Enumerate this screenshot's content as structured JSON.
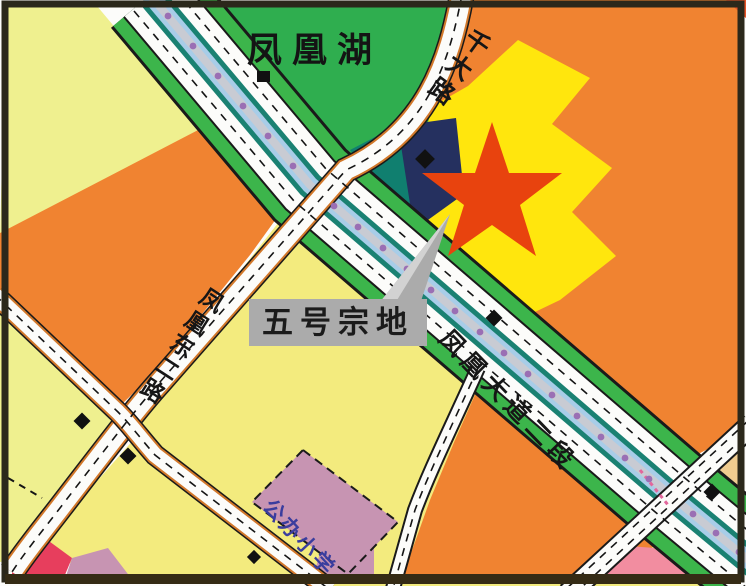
{
  "map": {
    "labels": {
      "lake": "凤凰湖",
      "plot_callout": "五号宗地",
      "school": "公办小学",
      "road_main": "凤凰大道二段",
      "road_north": "千大路",
      "road_west": "凤凰东二路"
    },
    "colors": {
      "park_green": "#2FAE4F",
      "verge_green": "#3CB54B",
      "median_teal": "#1A8172",
      "median_blue": "#A8CDE8",
      "median_gray": "#C8CBD3",
      "tree_purple": "#9A6FB4",
      "road_white": "#FCFCFA",
      "road_edge": "#1A1A1A",
      "minor_edge_orange": "#D2782A",
      "parcel_pale_yellow": "#EFF08F",
      "parcel_yellow": "#F3EB7E",
      "parcel_orange": "#F08331",
      "plot_yellow": "#FFE60D",
      "parcel_navy": "#25305F",
      "parcel_teal": "#107F6F",
      "parcel_mauve": "#C794B2",
      "parcel_red": "#E73E5D",
      "parcel_pink": "#F28DA0",
      "parcel_tan": "#F0CC90",
      "corner_red": "#E85327",
      "star_red": "#E8430E",
      "callout_gray": "#ABABAB",
      "ink": "#141414",
      "school_ink": "#3A3D9E",
      "crosswalk_pink": "#E2679C",
      "frame": "#2B281B"
    }
  }
}
